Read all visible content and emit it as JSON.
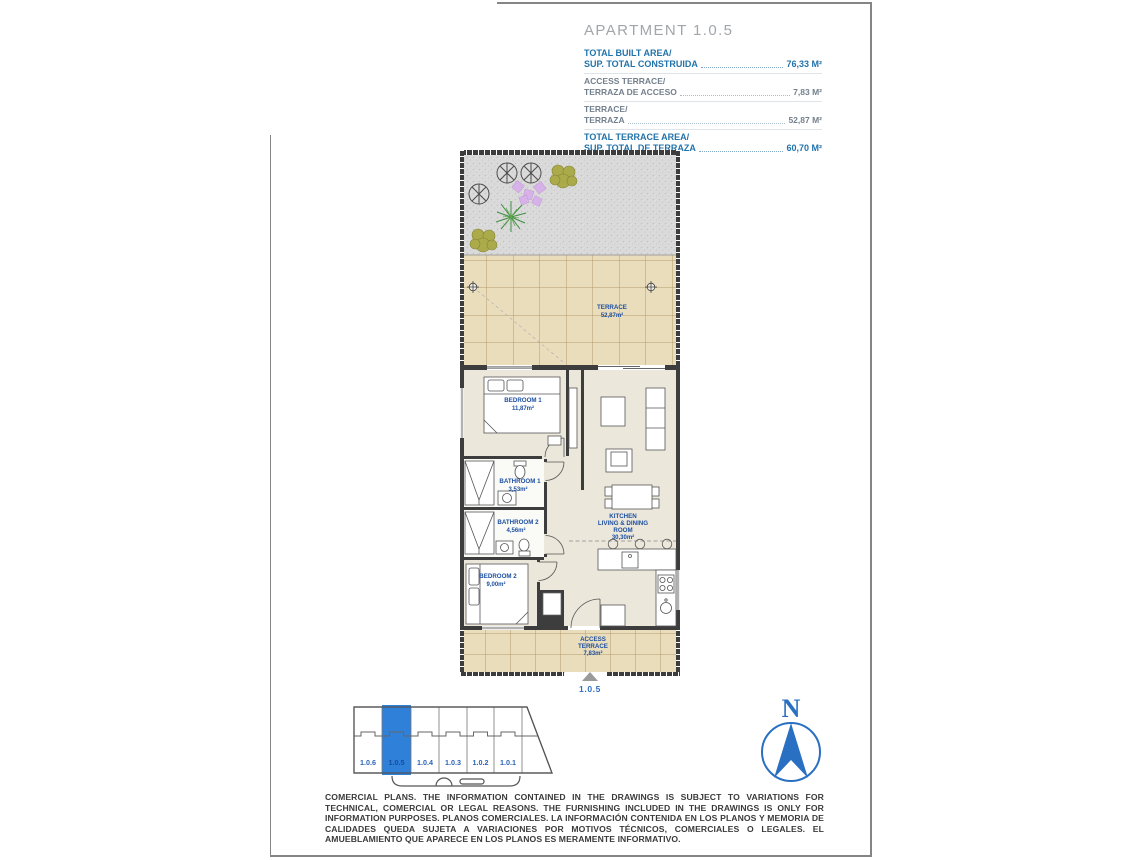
{
  "header": {
    "title": "APARTMENT 1.0.5",
    "rows": [
      {
        "label_en": "TOTAL BUILT AREA/",
        "label_es": "SUP. TOTAL CONSTRUIDA",
        "value": "76,33 M²",
        "emphasis": true
      },
      {
        "label_en": "ACCESS TERRACE/",
        "label_es": "TERRAZA DE ACCESO",
        "value": "7,83 M²",
        "emphasis": false
      },
      {
        "label_en": "TERRACE/",
        "label_es": "TERRAZA",
        "value": "52,87 M²",
        "emphasis": false
      },
      {
        "label_en": "TOTAL TERRACE AREA/",
        "label_es": "SUP. TOTAL DE TERRAZA",
        "value": "60,70 M²",
        "emphasis": true
      }
    ]
  },
  "plan": {
    "rooms": {
      "terrace": {
        "name": "TERRACE",
        "area": "52,87m²"
      },
      "bedroom1": {
        "name": "BEDROOM 1",
        "area": "11,87m²"
      },
      "bathroom1": {
        "name": "BATHROOM 1",
        "area": "3,53m²"
      },
      "bathroom2": {
        "name": "BATHROOM 2",
        "area": "4,56m²"
      },
      "bedroom2": {
        "name": "BEDROOM 2",
        "area": "9,00m²"
      },
      "kitchen": {
        "name_line1": "KITCHEN",
        "name_line2": "LIVING & DINING",
        "name_line3": "ROOM",
        "area": "30,30m²"
      },
      "access_terrace": {
        "name_line1": "ACCESS",
        "name_line2": "TERRACE",
        "area": "7,83m²"
      }
    },
    "unit_marker": "1.0.5"
  },
  "key_plan": {
    "units": [
      {
        "id": "1.0.6",
        "highlighted": false
      },
      {
        "id": "1.0.5",
        "highlighted": true
      },
      {
        "id": "1.0.4",
        "highlighted": false
      },
      {
        "id": "1.0.3",
        "highlighted": false
      },
      {
        "id": "1.0.2",
        "highlighted": false
      },
      {
        "id": "1.0.1",
        "highlighted": false
      }
    ]
  },
  "compass": {
    "label": "N"
  },
  "disclaimer": {
    "text": "COMERCIAL PLANS. THE INFORMATION CONTAINED IN THE DRAWINGS IS SUBJECT TO VARIATIONS FOR TECHNICAL, COMERCIAL OR LEGAL REASONS. THE FURNISHING INCLUDED IN THE DRAWINGS IS ONLY FOR INFORMATION PURPOSES. PLANOS COMERCIALES. LA INFORMACIÓN CONTENIDA EN LOS PLANOS Y MEMORIA DE CALIDADES QUEDA SUJETA A VARIACIONES POR MOTIVOS TÉCNICOS, COMERCIALES O LEGALES. EL AMUEBLAMIENTO QUE APARECE EN LOS PLANOS ES MERAMENTE INFORMATIVO."
  },
  "colors": {
    "accent_blue": "#2273ab",
    "muted_blue_gray": "#73808d",
    "plan_label_blue": "#1d4fa1",
    "highlight_blue": "#2e80d8",
    "terrace_tile": "#e9ddbc",
    "interior_floor": "#ece7db",
    "wall": "#3d3d3d"
  }
}
